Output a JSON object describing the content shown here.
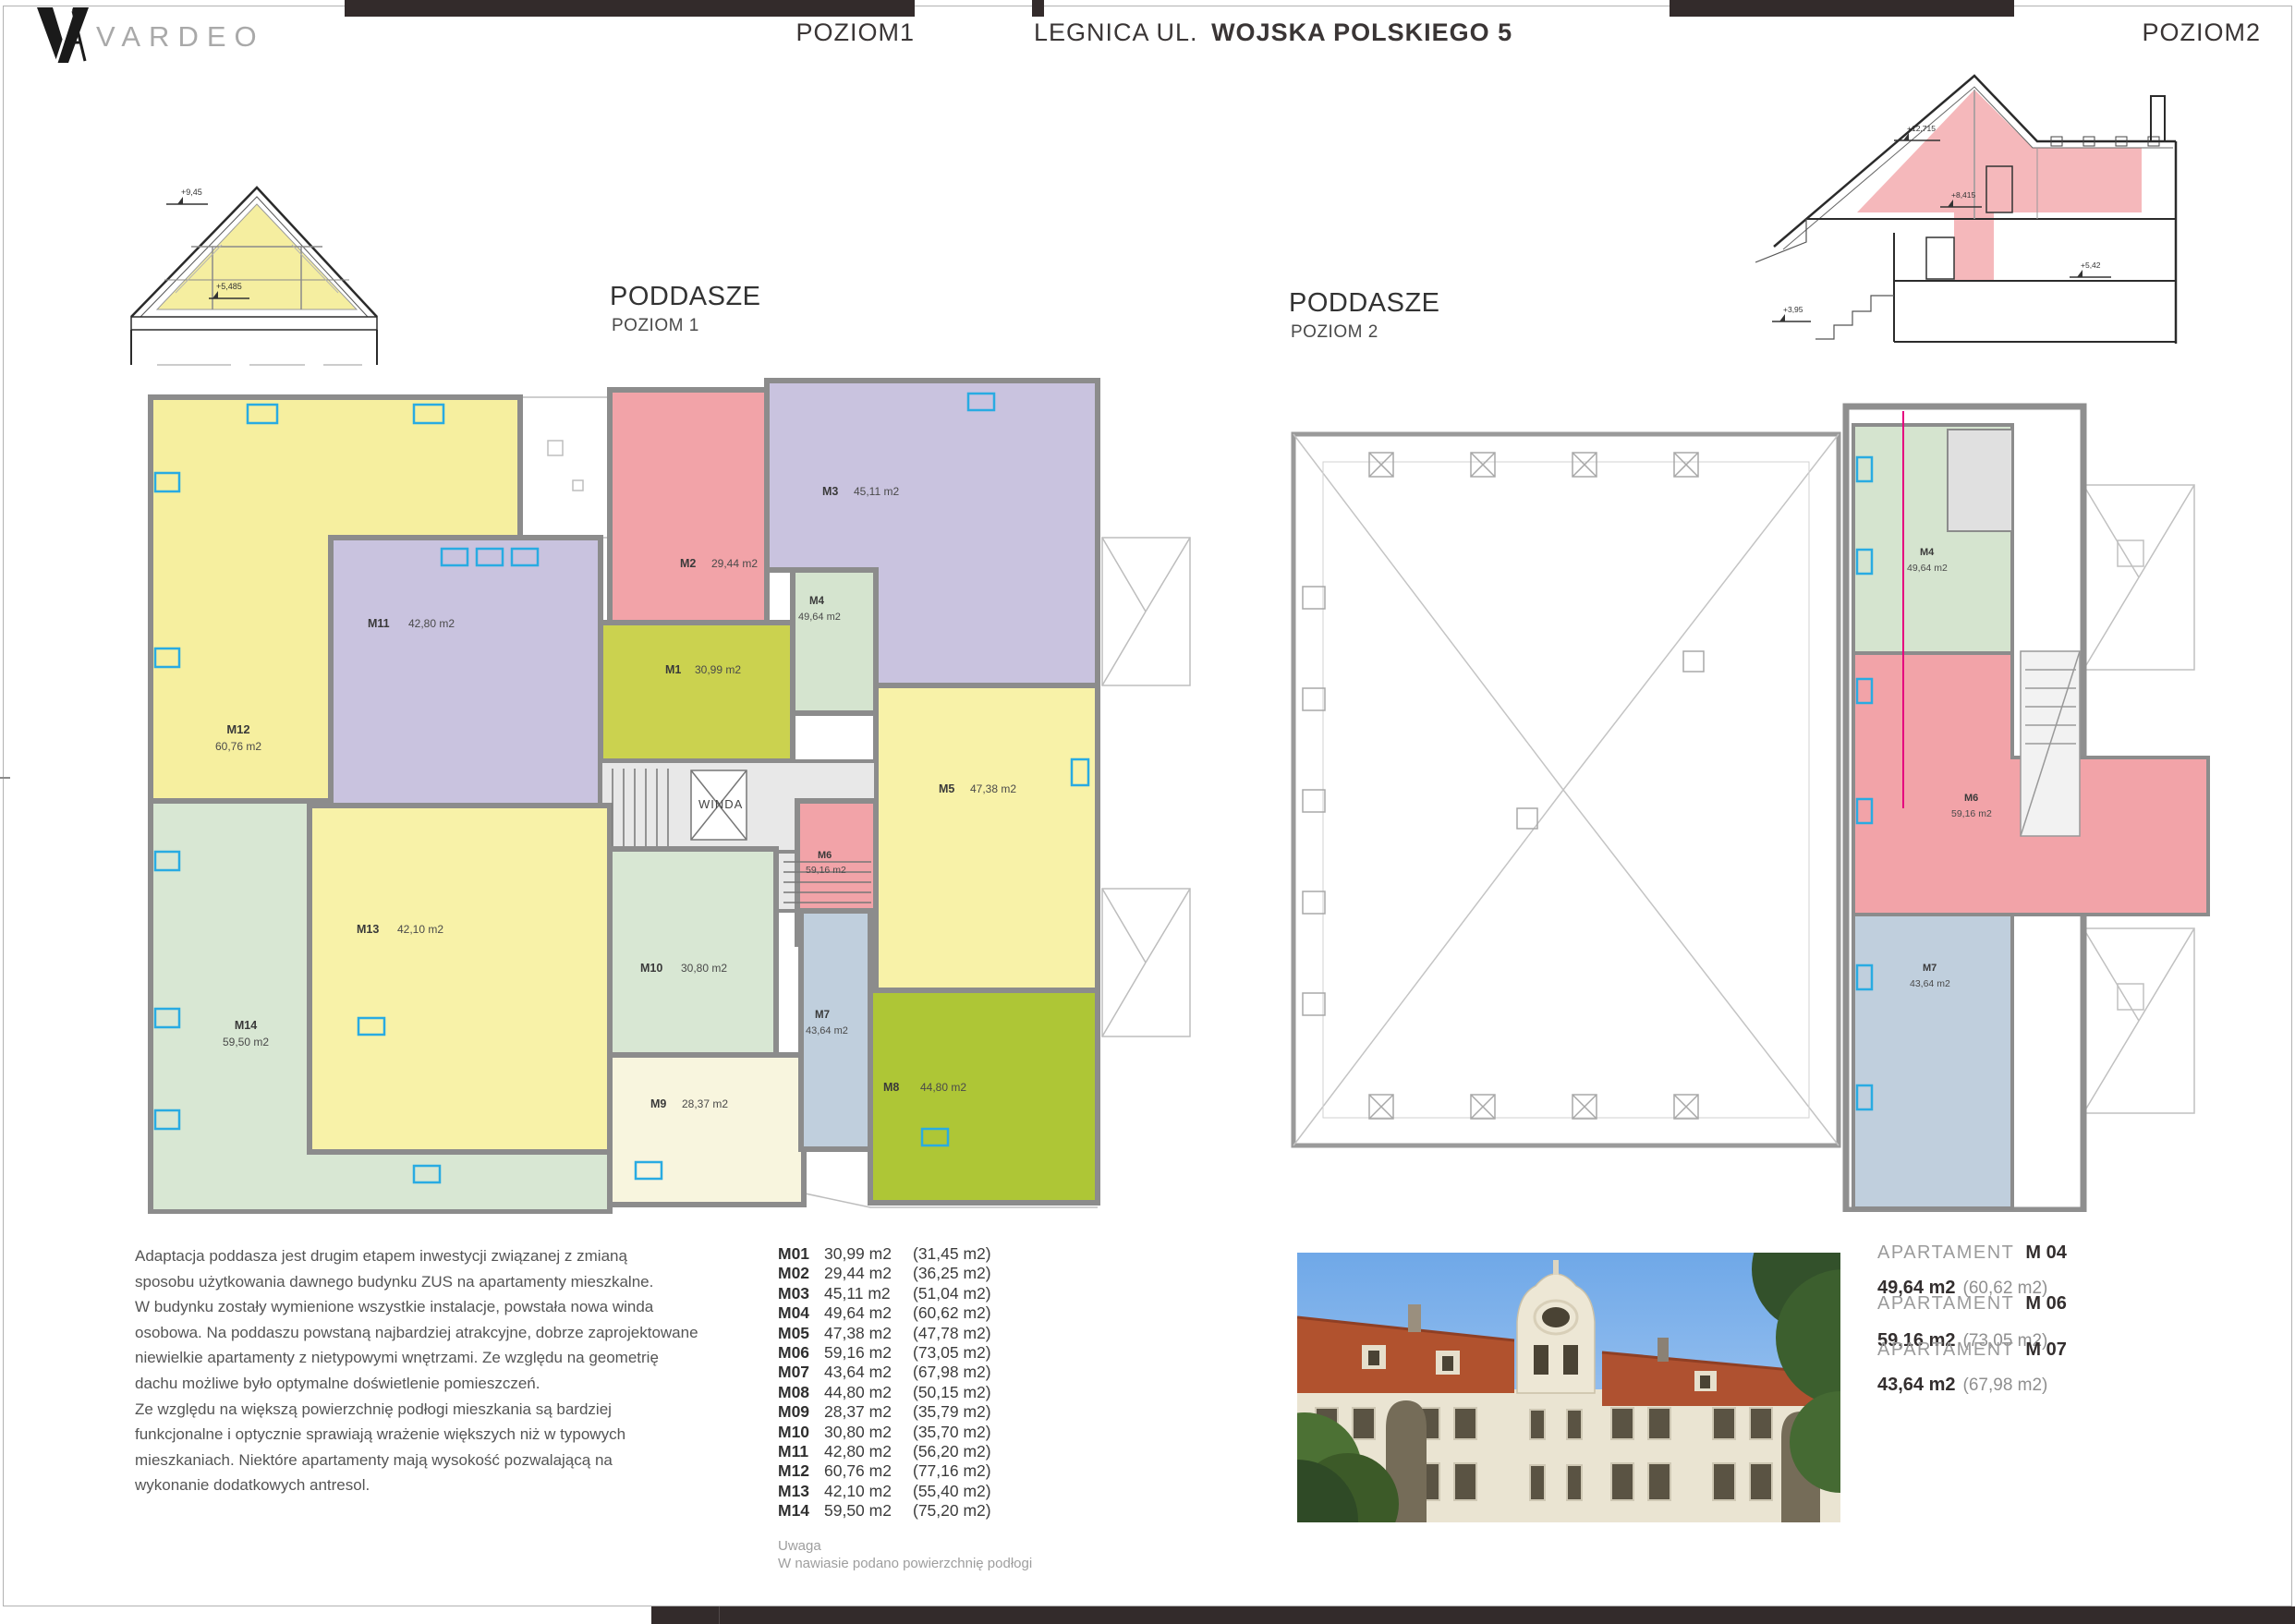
{
  "header": {
    "brand_text": "VARDEO",
    "level_left": "POZIOM1",
    "address_regular": "LEGNICA UL.",
    "address_bold": "WOJSKA POLSKIEGO 5",
    "level_right": "POZIOM2"
  },
  "plan1": {
    "title": "PODDASZE",
    "subtitle": "POZIOM 1",
    "elevator_label": "WINDA",
    "apartments": [
      {
        "code": "M12",
        "area": "60,76 m2"
      },
      {
        "code": "M11",
        "area": "42,80 m2"
      },
      {
        "code": "M2",
        "area": "29,44 m2"
      },
      {
        "code": "M3",
        "area": "45,11 m2"
      },
      {
        "code": "M4",
        "area": "49,64 m2"
      },
      {
        "code": "M1",
        "area": "30,99 m2"
      },
      {
        "code": "M5",
        "area": "47,38 m2"
      },
      {
        "code": "M6",
        "area": "59,16 m2"
      },
      {
        "code": "M10",
        "area": "30,80 m2"
      },
      {
        "code": "M13",
        "area": "42,10 m2"
      },
      {
        "code": "M14",
        "area": "59,50 m2"
      },
      {
        "code": "M9",
        "area": "28,37 m2"
      },
      {
        "code": "M7",
        "area": "43,64 m2"
      },
      {
        "code": "M8",
        "area": "44,80 m2"
      }
    ]
  },
  "plan2": {
    "title": "PODDASZE",
    "subtitle": "POZIOM 2",
    "apartments": [
      {
        "code": "M4",
        "area": "49,64 m2"
      },
      {
        "code": "M6",
        "area": "59,16 m2"
      },
      {
        "code": "M7",
        "area": "43,64 m2"
      }
    ]
  },
  "sections": {
    "left": {
      "elevations": [
        "+9,45",
        "+5,485"
      ]
    },
    "right": {
      "elevations": [
        "+12,715",
        "+8,415",
        "+5,42",
        "+3,95"
      ]
    }
  },
  "description": {
    "text": "Adaptacja poddasza jest drugim etapem inwestycji związanej z zmianą\nsposobu użytkowania dawnego budynku ZUS na apartamenty mieszkalne.\nW budynku zostały wymienione wszystkie instalacje, powstała nowa winda\nosobowa. Na poddaszu powstaną najbardziej atrakcyjne, dobrze zaprojektowane\nniewielkie apartamenty z nietypowymi wnętrzami. Ze względu na geometrię\ndachu możliwe było optymalne doświetlenie pomieszczeń.\nZe względu na większą powierzchnię podłogi mieszkania są bardziej\nfunkcjonalne i optycznie sprawiają wrażenie większych niż w typowych\nmieszkaniach. Niektóre apartamenty mają wysokość pozwalającą na\nwykonanie dodatkowych antresol."
  },
  "units": {
    "rows": [
      {
        "code": "M01",
        "area": "30,99 m2",
        "floor": "(31,45 m2)"
      },
      {
        "code": "M02",
        "area": "29,44 m2",
        "floor": "(36,25 m2)"
      },
      {
        "code": "M03",
        "area": "45,11 m2",
        "floor": "(51,04 m2)"
      },
      {
        "code": "M04",
        "area": "49,64 m2",
        "floor": "(60,62 m2)"
      },
      {
        "code": "M05",
        "area": "47,38 m2",
        "floor": "(47,78 m2)"
      },
      {
        "code": "M06",
        "area": "59,16 m2",
        "floor": "(73,05 m2)"
      },
      {
        "code": "M07",
        "area": "43,64 m2",
        "floor": "(67,98 m2)"
      },
      {
        "code": "M08",
        "area": "44,80 m2",
        "floor": "(50,15 m2)"
      },
      {
        "code": "M09",
        "area": "28,37 m2",
        "floor": "(35,79 m2)"
      },
      {
        "code": "M10",
        "area": "30,80 m2",
        "floor": "(35,70 m2)"
      },
      {
        "code": "M11",
        "area": "42,80 m2",
        "floor": "(56,20 m2)"
      },
      {
        "code": "M12",
        "area": "60,76 m2",
        "floor": "(77,16 m2)"
      },
      {
        "code": "M13",
        "area": "42,10 m2",
        "floor": "(55,40 m2)"
      },
      {
        "code": "M14",
        "area": "59,50 m2",
        "floor": "(75,20 m2)"
      }
    ]
  },
  "note": {
    "title": "Uwaga",
    "text": "W nawiasie podano powierzchnię podłogi"
  },
  "featured": {
    "items": [
      {
        "label": "APARTAMENT",
        "code": "M 04",
        "area": "49,64 m2",
        "floor": "(60,62 m2)"
      },
      {
        "label": "APARTAMENT",
        "code": "M 06",
        "area": "59,16 m2",
        "floor": "(73,05 m2)"
      },
      {
        "label": "APARTAMENT",
        "code": "M 07",
        "area": "43,64 m2",
        "floor": "(67,98 m2)"
      }
    ]
  },
  "colors": {
    "accent_cyan": "#29ABE2",
    "wall_gray": "#8C8C8C",
    "bar_dark": "#332B2B",
    "yellow": "#F6EF9F",
    "lavender": "#C9C3DF",
    "pink": "#F2A3A8",
    "olive": "#CBD24F",
    "pale_yellow": "#F8F2A8",
    "light_green": "#D5E4CF",
    "pale_green": "#D8E7D3",
    "cream": "#F8F5DE",
    "blue_gray": "#C0CFDD",
    "bright_green": "#AEC636",
    "section_yellow": "#F5EEA0",
    "section_pink": "#F2A6AA",
    "magenta_line": "#E5007E"
  }
}
